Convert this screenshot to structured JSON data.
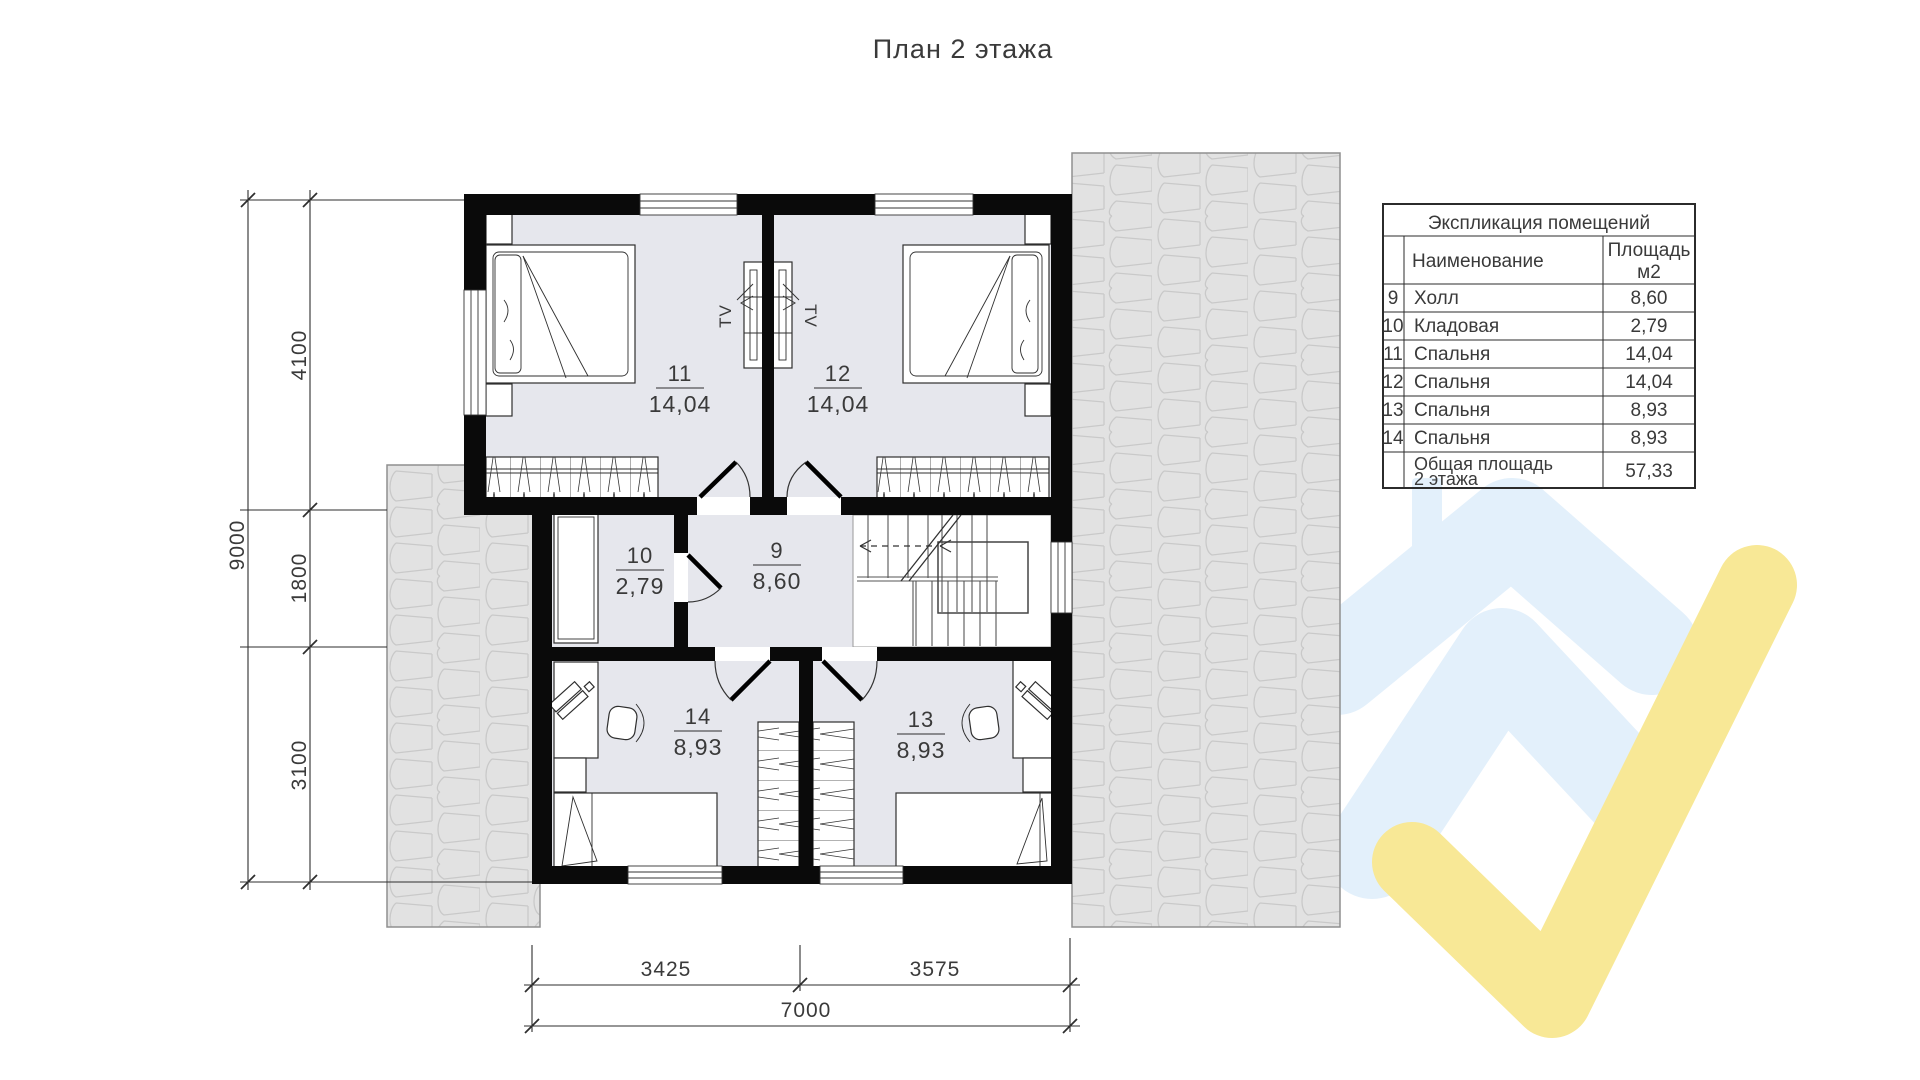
{
  "title": "План 2 этажа",
  "legend": {
    "title": "Экспликация помещений",
    "columns": {
      "name": "Наименование",
      "area_line1": "Площадь",
      "area_line2": "м2"
    },
    "rows": [
      {
        "num": "9",
        "name": "Холл",
        "area": "8,60"
      },
      {
        "num": "10",
        "name": "Кладовая",
        "area": "2,79"
      },
      {
        "num": "11",
        "name": "Спальня",
        "area": "14,04"
      },
      {
        "num": "12",
        "name": "Спальня",
        "area": "14,04"
      },
      {
        "num": "13",
        "name": "Спальня",
        "area": "8,93"
      },
      {
        "num": "14",
        "name": "Спальня",
        "area": "8,93"
      }
    ],
    "total": {
      "name_line1": "Общая площадь",
      "name_line2": "2 этажа",
      "area": "57,33"
    }
  },
  "rooms": {
    "r9": {
      "num": "9",
      "area": "8,60"
    },
    "r10": {
      "num": "10",
      "area": "2,79"
    },
    "r11": {
      "num": "11",
      "area": "14,04"
    },
    "r12": {
      "num": "12",
      "area": "14,04"
    },
    "r13": {
      "num": "13",
      "area": "8,93"
    },
    "r14": {
      "num": "14",
      "area": "8,93"
    }
  },
  "dims": {
    "left_total": "9000",
    "left_seg1": "4100",
    "left_seg2": "1800",
    "left_seg3": "3100",
    "bottom_seg1": "3425",
    "bottom_seg2": "3575",
    "bottom_total": "7000"
  },
  "labels": {
    "tv": "TV"
  },
  "colors": {
    "room_fill": "#e6e7ed",
    "wall": "#0a0a0a",
    "roof_fill": "#e2e2e2",
    "watermark_blue": "#e3f0fb",
    "watermark_yellow": "#f8e896"
  }
}
